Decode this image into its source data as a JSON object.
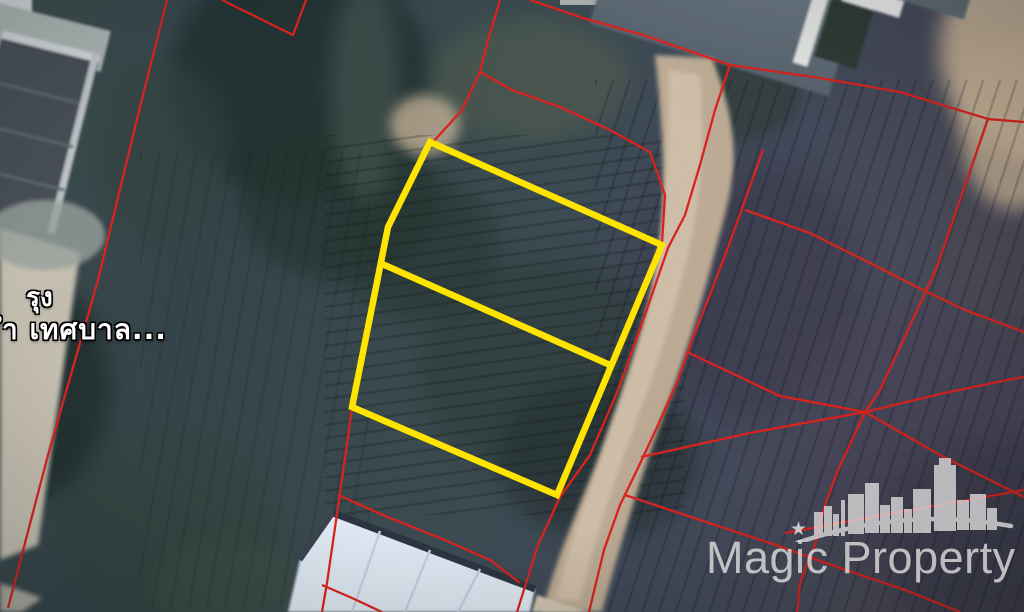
{
  "map": {
    "kind": "satellite view with cadastral parcel overlay",
    "size": {
      "width": 1024,
      "height": 612
    },
    "labels": {
      "line1": "รุง",
      "line2": "ำ เทศบาล...",
      "color": "#ffffff"
    },
    "watermark": {
      "text": "Magic Property",
      "star": "★",
      "logo": "city-skyline-arc-logo",
      "color": "#dcdcdc"
    },
    "highlight_plot": {
      "color": "#ffe400",
      "stroke_width": 6.5,
      "outline": [
        [
          430,
          142
        ],
        [
          662,
          245
        ],
        [
          557,
          495
        ],
        [
          352,
          407
        ],
        [
          388,
          227
        ]
      ],
      "divider": [
        [
          380,
          263
        ],
        [
          610,
          365
        ]
      ]
    },
    "parcel_lines": {
      "color": "#d8231f",
      "stroke_width": 2.3,
      "polylines": [
        {
          "name": "west-boundary",
          "points": [
            [
              167,
              0
            ],
            [
              138,
              115
            ],
            [
              98,
              280
            ],
            [
              48,
              455
            ],
            [
              8,
              608
            ]
          ]
        },
        {
          "name": "north-notch",
          "points": [
            [
              222,
              0
            ],
            [
              293,
              35
            ],
            [
              306,
              0
            ]
          ]
        },
        {
          "name": "northeast-corner-line",
          "points": [
            [
              500,
              0
            ],
            [
              488,
              40
            ],
            [
              480,
              72
            ],
            [
              462,
              110
            ],
            [
              433,
              142
            ]
          ]
        },
        {
          "name": "branch-to-plot-ne-corner",
          "points": [
            [
              480,
              72
            ],
            [
              512,
              90
            ],
            [
              560,
              107
            ],
            [
              610,
              130
            ],
            [
              650,
              152
            ],
            [
              665,
              195
            ],
            [
              662,
              243
            ]
          ]
        },
        {
          "name": "north-long-boundary",
          "points": [
            [
              530,
              0
            ],
            [
              583,
              18
            ],
            [
              643,
              35
            ],
            [
              730,
              65
            ],
            [
              820,
              78
            ],
            [
              900,
              92
            ],
            [
              988,
              119
            ],
            [
              1024,
              122
            ]
          ]
        },
        {
          "name": "road-west-edge",
          "points": [
            [
              730,
              65
            ],
            [
              715,
              110
            ],
            [
              700,
              165
            ],
            [
              685,
              215
            ],
            [
              668,
              248
            ],
            [
              645,
              315
            ],
            [
              618,
              390
            ],
            [
              590,
              455
            ],
            [
              560,
              497
            ],
            [
              538,
              545
            ],
            [
              517,
              612
            ]
          ]
        },
        {
          "name": "road-east-edge",
          "points": [
            [
              763,
              150
            ],
            [
              745,
              200
            ],
            [
              727,
              250
            ],
            [
              710,
              295
            ],
            [
              693,
              337
            ],
            [
              678,
              380
            ],
            [
              658,
              425
            ],
            [
              638,
              468
            ],
            [
              620,
              505
            ],
            [
              604,
              550
            ],
            [
              589,
              612
            ]
          ]
        },
        {
          "name": "east-divider-upper",
          "points": [
            [
              745,
              210
            ],
            [
              810,
              233
            ],
            [
              870,
              263
            ],
            [
              917,
              287
            ],
            [
              965,
              310
            ],
            [
              1024,
              332
            ]
          ]
        },
        {
          "name": "east-vertical-boundary",
          "points": [
            [
              988,
              119
            ],
            [
              960,
              200
            ],
            [
              937,
              267
            ],
            [
              908,
              330
            ],
            [
              880,
              390
            ],
            [
              865,
              412
            ],
            [
              838,
              470
            ],
            [
              825,
              505
            ],
            [
              815,
              545
            ],
            [
              800,
              583
            ],
            [
              797,
              612
            ]
          ]
        },
        {
          "name": "east-divider-rising",
          "points": [
            [
              641,
              457
            ],
            [
              750,
              433
            ],
            [
              865,
              412
            ],
            [
              940,
              394
            ],
            [
              1012,
              379
            ],
            [
              1024,
              377
            ]
          ]
        },
        {
          "name": "east-divider-falling",
          "points": [
            [
              687,
              352
            ],
            [
              780,
              396
            ],
            [
              865,
              412
            ],
            [
              940,
              455
            ],
            [
              1024,
              497
            ]
          ]
        },
        {
          "name": "east-divider-lower",
          "points": [
            [
              785,
              533
            ],
            [
              900,
              512
            ],
            [
              1024,
              490
            ]
          ]
        },
        {
          "name": "south-divider",
          "points": [
            [
              625,
              495
            ],
            [
              700,
              520
            ],
            [
              770,
              543
            ],
            [
              840,
              568
            ],
            [
              905,
              590
            ],
            [
              960,
              612
            ]
          ]
        },
        {
          "name": "plot-west-under-highlight",
          "points": [
            [
              428,
              144
            ],
            [
              386,
              229
            ],
            [
              350,
              409
            ]
          ]
        },
        {
          "name": "plot-west-continuation",
          "points": [
            [
              352,
              408
            ],
            [
              340,
              493
            ],
            [
              327,
              583
            ],
            [
              322,
              612
            ]
          ]
        },
        {
          "name": "warehouse-divider",
          "points": [
            [
              338,
              495
            ],
            [
              390,
              518
            ],
            [
              445,
              540
            ],
            [
              490,
              560
            ],
            [
              520,
              583
            ]
          ]
        },
        {
          "name": "southwest-branch",
          "points": [
            [
              322,
              585
            ],
            [
              352,
              598
            ],
            [
              382,
              612
            ]
          ]
        }
      ]
    }
  }
}
